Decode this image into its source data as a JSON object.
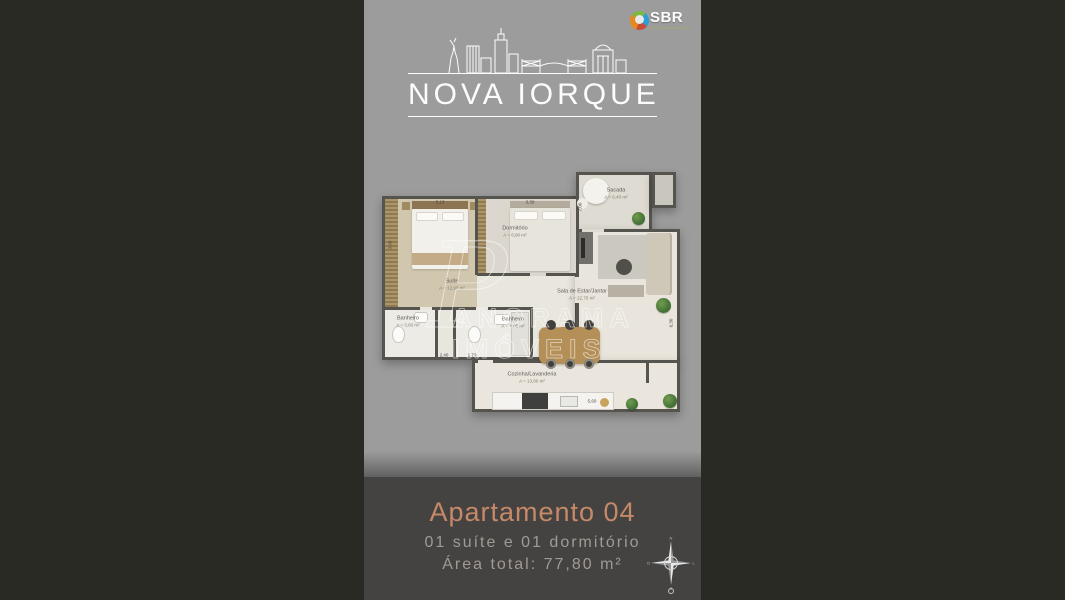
{
  "brand": {
    "name": "SBR",
    "subtitle": "empreendimentos"
  },
  "logo": {
    "title": "NOVA IORQUE"
  },
  "floorplan": {
    "watermark": {
      "initial": "P",
      "rest": "ANORAMA IMÓVEIS"
    },
    "rooms": [
      {
        "name": "Suíte",
        "area": "A = 12,90 m²"
      },
      {
        "name": "Dormitório",
        "area": "A = 8,90 m²"
      },
      {
        "name": "Sacada",
        "area": "A = 6,40 m²"
      },
      {
        "name": "Sala de Estar/Jantar",
        "area": "A = 22,75 m²"
      },
      {
        "name": "Banheiro",
        "area": "A = 3,60 m²"
      },
      {
        "name": "Banheiro",
        "area": "A = 4,05 m²"
      },
      {
        "name": "Cozinha/Lavanderia",
        "area": "A = 13,80 m²"
      }
    ],
    "dimensions": {
      "top_suite": "5,13",
      "top_dorm": "3,30",
      "left_suite": "3,90",
      "sacada_side": "7,00",
      "bath1_width": "2,40",
      "bath2_width": "1,70",
      "kitchen_width": "5,60",
      "sala_height": "6,30"
    }
  },
  "footer": {
    "title": "Apartamento 04",
    "subtitle": "01 suíte e 01 dormitório",
    "area_total": "Área total: 77,80 m²"
  },
  "compass": {
    "n": "N",
    "e": "L",
    "s": "S",
    "w": "O"
  },
  "colors": {
    "accent": "#c58968",
    "poster_gray": "#9c9c9c",
    "footer_band": "#454342",
    "background": "#2a2a24"
  }
}
